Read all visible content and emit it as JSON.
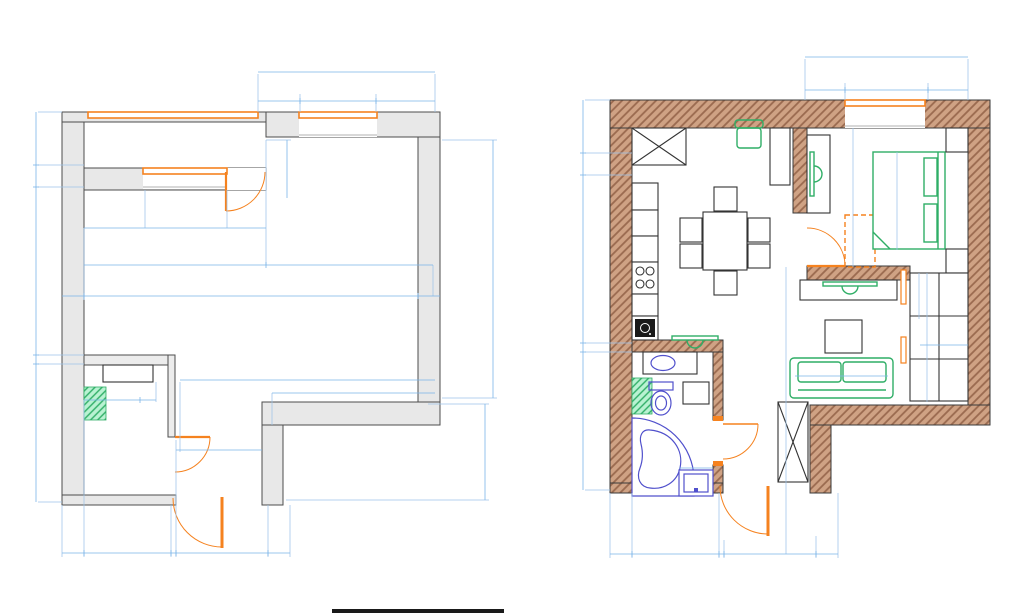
{
  "title": "Обмерочный план",
  "colors": {
    "dimension_blue": "#4a90d9",
    "dimension_violet": "#5b5bd6",
    "title_blue": "#4a86c8",
    "opening_orange": "#f5821f",
    "furniture_green": "#2fae66",
    "fixture_blue": "#5050cc",
    "wall_gray": "#e8e8e8",
    "wall_brown_hatch": "#cfa284",
    "vent_green_hatch": "#b9f2d2"
  },
  "lp": {
    "top_total": "3 410",
    "top_a": "820",
    "top_b": "1 700",
    "top_c": "890",
    "left_a": "1 100",
    "left_b": "450",
    "left_c": "3 550",
    "left_d": "188",
    "left_e": "2 850",
    "bot_a": "450",
    "bot_b": "1 800",
    "bot_c": "100",
    "bot_d": "1 890",
    "bot_e": "450",
    "right_a": "5 729",
    "right_b": "2 060",
    "in_a": "1 240",
    "in_b": "1 700",
    "in_c": "800",
    "in_d": "1 200",
    "in_e": "3 740",
    "in_f": "3 410",
    "in_g": "450",
    "in_h": "7 150",
    "in_i": "450",
    "in_j": "5 250",
    "in_k": "3 380",
    "in_l": "100",
    "in_m": "1 130",
    "in_n": "322",
    "in_o": "1 890"
  },
  "rp": {
    "top_total": "3 410",
    "top_a": "820",
    "top_b": "1 700",
    "top_c": "890",
    "left_a": "1 100",
    "left_b": "450",
    "left_c": "3 550",
    "left_d": "188",
    "left_e": "2 850",
    "bot_a": "450",
    "bot_b": "1 800",
    "bot_c": "100",
    "bot_d": "1 890",
    "bot_e": "450",
    "fridge": "ХОЛ",
    "wm": "СМ",
    "bed_h": "2 976",
    "bed_w": "2 030",
    "hall_a": "1 874",
    "hall_b": "950",
    "liv_a": "1 361",
    "liv_b": "2 653",
    "sofa": "2 100",
    "cl_a": "950",
    "cl_b": "2 653",
    "cl_c": "1 380",
    "wm_w": "750",
    "bath_a": "1 500",
    "bath_b": "600"
  }
}
